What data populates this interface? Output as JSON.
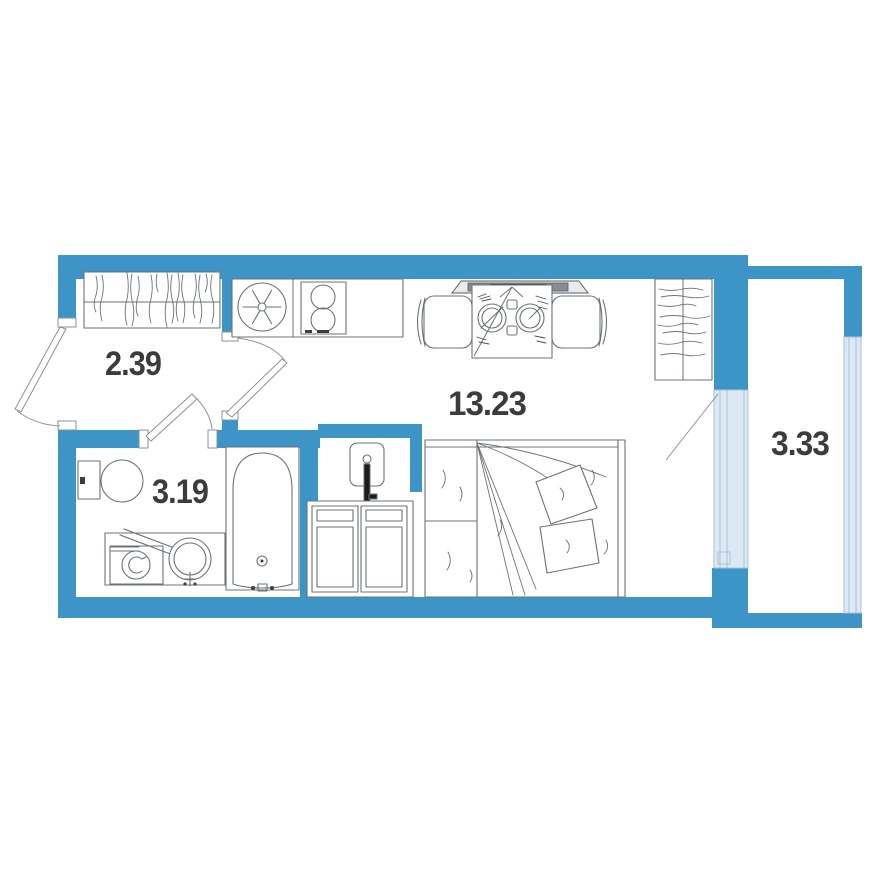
{
  "title": "Studio apartment floor plan",
  "rooms": {
    "hallway": {
      "id": "hallway",
      "area": "2.39"
    },
    "bathroom": {
      "id": "bathroom",
      "area": "3.19"
    },
    "living": {
      "id": "living-kitchen",
      "area": "13.23"
    },
    "balcony": {
      "id": "balcony",
      "area": "3.33"
    }
  },
  "colors": {
    "wall": "#3d94c7",
    "glazing_fill": "#dce9f4",
    "glazing_line": "#a9c3d6",
    "furniture_line": "#6b7378",
    "dark_detail": "#3a3e42",
    "label_text": "#3c3c3c",
    "background": "#ffffff"
  },
  "furniture": [
    "hallway-wardrobe",
    "kitchen-counter",
    "kitchen-sink",
    "stove",
    "dining-table",
    "dining-chair-left",
    "dining-chair-right",
    "window-sill-radiator",
    "wardrobe",
    "entrance-door",
    "room-door",
    "bathroom-door",
    "balcony-door",
    "toilet",
    "washing-machine",
    "vessel-sink",
    "bathtub",
    "water-heater",
    "cabinet",
    "double-bed"
  ]
}
